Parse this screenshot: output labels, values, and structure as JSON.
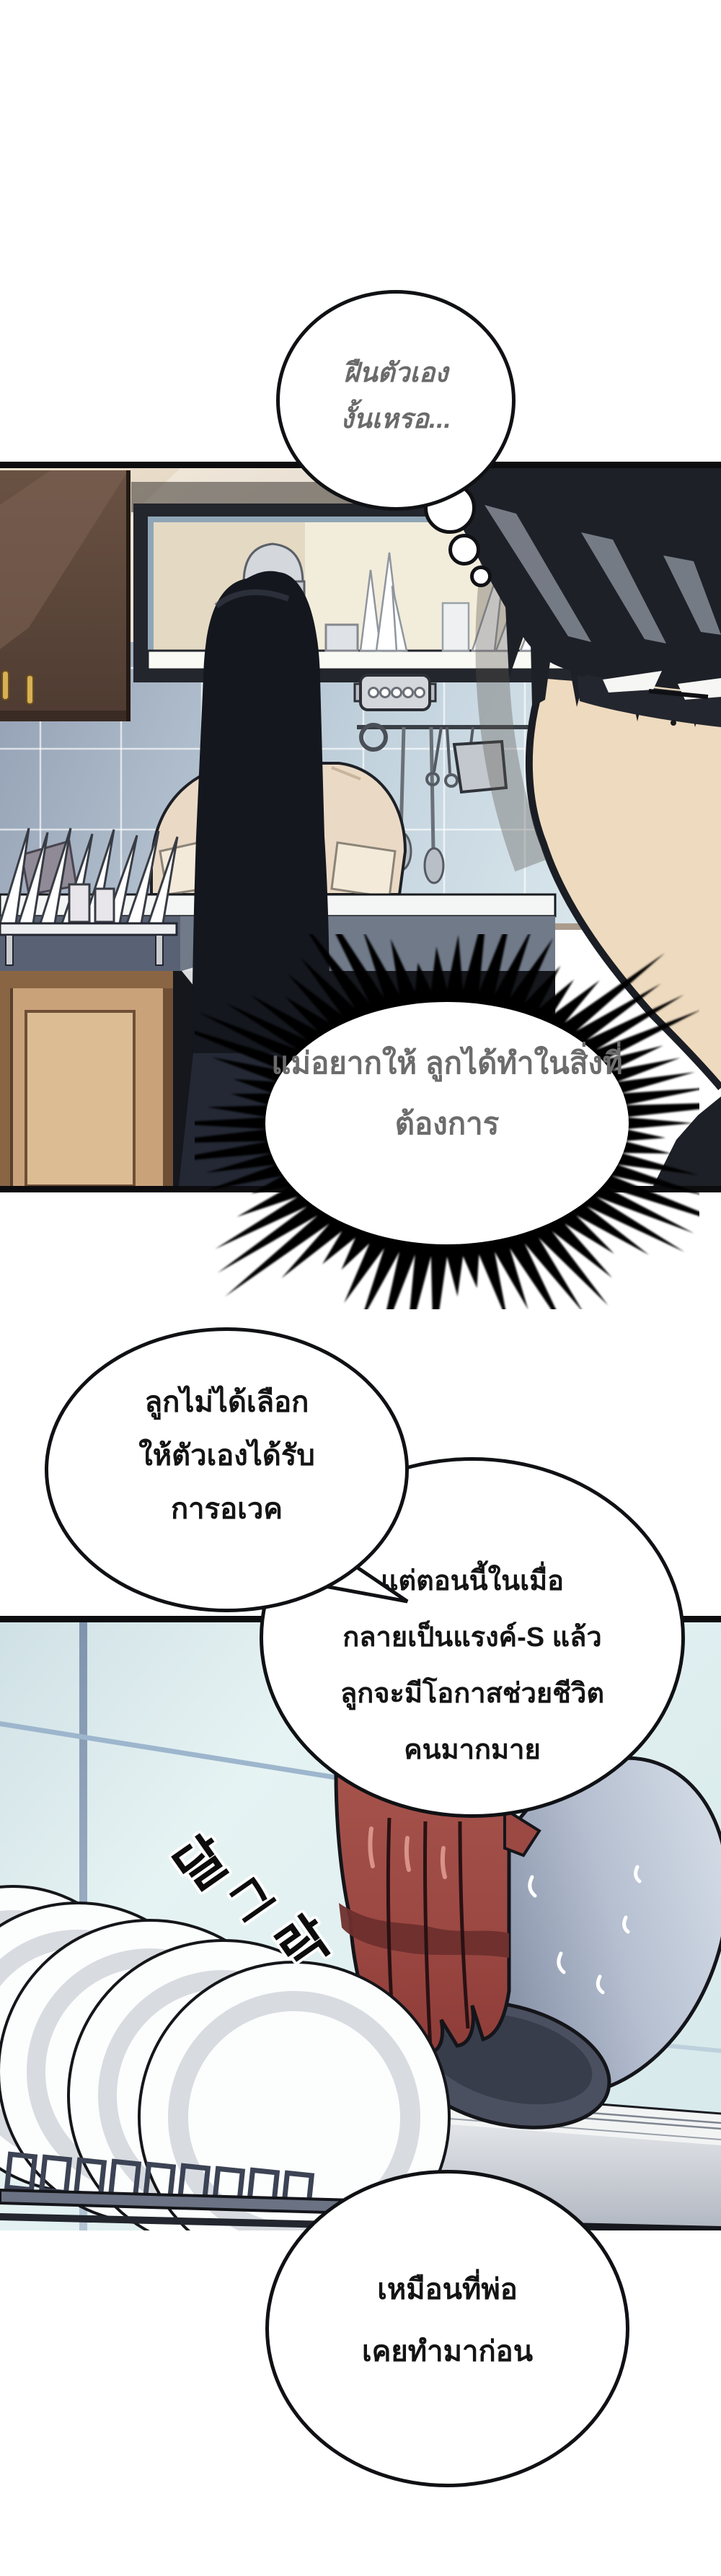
{
  "comic": {
    "thought_bubble": {
      "lines": [
        "ฝืนตัวเอง",
        "งั้นเหรอ..."
      ]
    },
    "inner_burst": {
      "lines": [
        "แม่อยากให้",
        "ลูกได้ทำในสิ่งที่",
        "ต้องการ"
      ]
    },
    "mom_bubble_1": {
      "lines": [
        "ลูกไม่ได้เลือก",
        "ให้ตัวเองได้รับ",
        "การอเวค"
      ]
    },
    "mom_bubble_2": {
      "lines": [
        "แต่ตอนนี้ในเมื่อ",
        "กลายเป็นแรงค์-S แล้ว",
        "ลูกจะมีโอกาสช่วยชีวิต",
        "คนมากมาย"
      ]
    },
    "mom_bubble_3": {
      "lines": [
        "เหมือนที่พ่อ",
        "เคยทำมาก่อน"
      ]
    },
    "sfx": {
      "chars": [
        "달",
        "그",
        "락"
      ]
    },
    "colors": {
      "page_bg": "#ffffff",
      "panel_border": "#0d0d0f",
      "thought_text": "#6a6a6a",
      "burst_text": "#6c6c6c",
      "speech_text": "#141414",
      "glove_red": "#9c4843",
      "bowl_grey": "#aab3c5",
      "tile_blue": "#c2d2dd",
      "tile_cyan": "#dcebee",
      "hair_dark": "#1d2026",
      "skin": "#eedabe",
      "wood_cabinet": "#5d4738",
      "lower_cabinet": "#caa27a"
    }
  }
}
